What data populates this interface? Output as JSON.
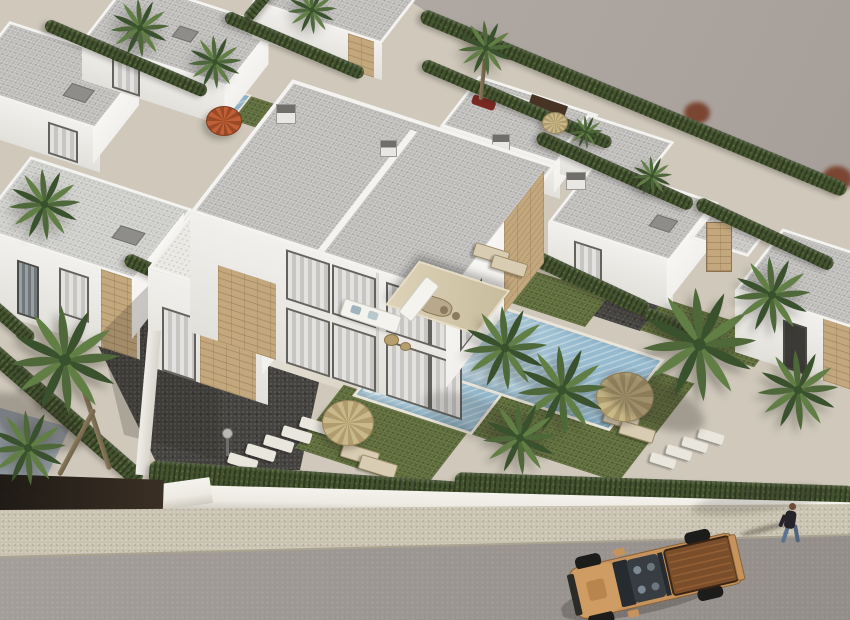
{
  "scene": {
    "description": "Aerial 3D architectural rendering of a modern Mediterranean villa development. A white two-storey duplex villa with floor-to-ceiling curtained windows, travertine stone accents, a beige pergola, corner sofa and sun terraces stands at the centre, each unit with its own turquoise pool, olive lawn, straw parasols and palm trees. Rows of similar flat-roofed white villas separated by tall cypress hedges fill the background, with an empty grey plot at the upper right. Along the bottom a white perimeter wall and hedge meet a beige sidewalk and grey street where a sand-coloured pickup truck is parked and a pedestrian walks.",
    "view": "aerial three-quarter",
    "setting": "residential development"
  },
  "palette": {
    "land": "#aca59f",
    "land_light": "#b6afa9",
    "dev_ground": "#cfc8bb",
    "patio": "#ddd6c6",
    "facade": "#f1f0ed",
    "facade_shade": "#e2e0da",
    "parapet": "#f4f3f0",
    "roof_gravel": "#bcbbb8",
    "stone": "#c3a87e",
    "hedge": "#43532f",
    "grass": "#5e6b3d",
    "pool_light": "#c4d9e2",
    "pool_deep": "#96bace",
    "gravel": "#454340",
    "wall_white": "#edeae2",
    "sidewalk": "#c9c2b0",
    "street": "#9e9894",
    "straw": "#c9b888",
    "straw_dark": "#b09c6e",
    "orange_parasol": "#c06037",
    "palm1": "#4e683a",
    "palm2": "#39512c",
    "palm3": "#617e45",
    "trunk_color": "#8c7c5e",
    "truck_body": "#c6935c",
    "truck_bed": "#7b4e2b",
    "truck_glass": "#262b30",
    "jeans": "#5d7190",
    "jacket": "#26242a",
    "shadow": "rgba(45,40,33,0.28)"
  },
  "objects": {
    "main_villa": {
      "type": "duplex",
      "storeys": 2,
      "units": 2,
      "features": [
        "flat gravel roof",
        "white parapet",
        "stone accent panels",
        "curtained glass walls",
        "pergola",
        "corner sofa",
        "sun loungers",
        "dining table"
      ]
    },
    "pools": 3,
    "background_villas": 9,
    "palm_trees": 15,
    "parasols": {
      "straw": 3,
      "orange": 1
    },
    "hedges": "cypress",
    "vehicle": {
      "type": "pickup-truck",
      "color": "#c6935c",
      "bed": "open"
    },
    "pedestrian": {
      "jacket": "#26242a",
      "trousers": "#5d7190"
    }
  }
}
